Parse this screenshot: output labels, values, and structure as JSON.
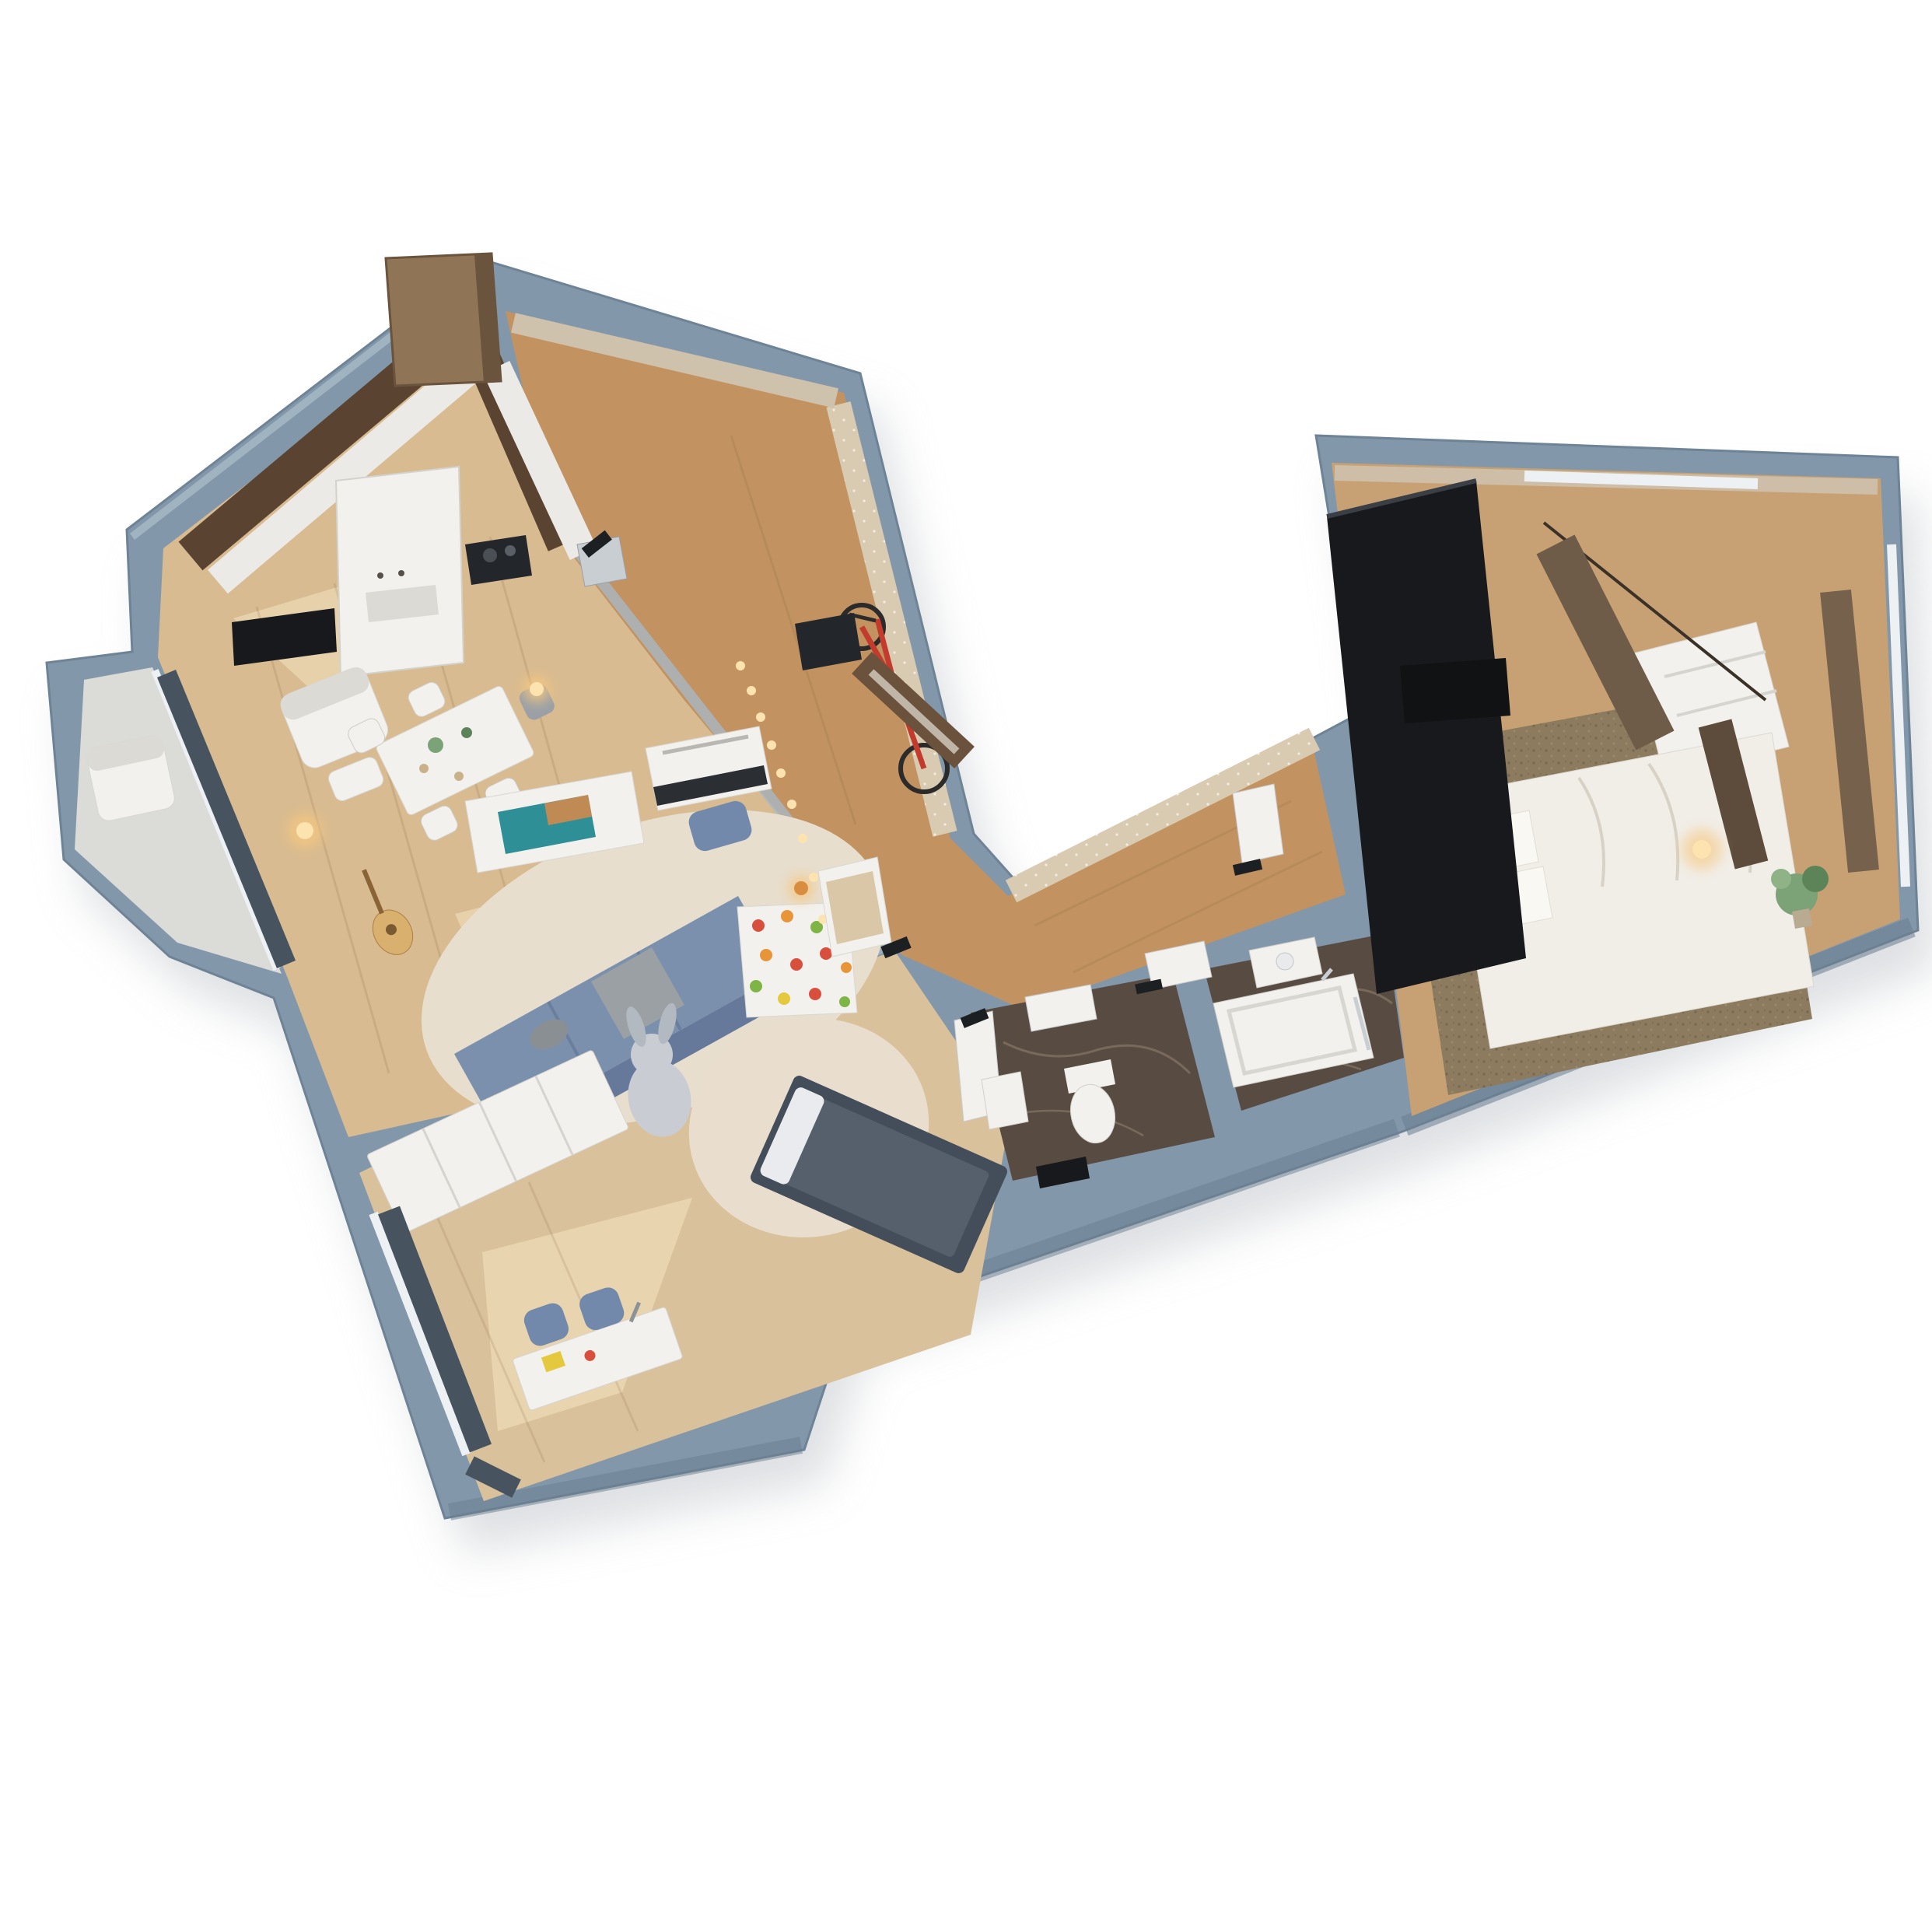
{
  "meta": {
    "title": "3D isometric apartment floor plan render",
    "view": "top-down axonometric cutaway, rotated",
    "background": "#ffffff"
  },
  "palette": {
    "bg": "#ffffff",
    "shadow": "#c3c8cd",
    "wall": "#8297a9",
    "wallDark": "#697e90",
    "wallLight": "#a7bac8",
    "wallFace": "#e8e6e1",
    "woodMain": "#d8bb91",
    "woodSun": "#f4e3c0",
    "woodHall": "#c29361",
    "woodKids": "#d9c19b",
    "woodBedroom": "#c7a173",
    "balconyFloor": "#dbdbd8",
    "marble": "#584c42",
    "marbleVein": "#8d7d6c",
    "rugCream": "#e7decd",
    "rugKids": "#e9dece",
    "rugBedroom": "#8d7b5f",
    "sofaBlue": "#7b90ad",
    "sofaBlueDark": "#66799a",
    "stoolBlue": "#7289ab",
    "kidsBed": "#434e5a",
    "kidsBedTop": "#55606c",
    "curtainSlate": "#47535f",
    "curtainBrown": "#6e5b48",
    "curtainBrownDark": "#5d4c3c",
    "furnWhite": "#f2f1ed",
    "furnWhiteShade": "#dcdad4",
    "tallWardrobeBrown": "#8f7456",
    "closetBrown": "#6b523c",
    "mirror": "#cfc8ba",
    "backsplash": "#5a4431",
    "counterWhite": "#eceae6",
    "applianceDark": "#23262a",
    "black": "#17191c",
    "bedWhite": "#f1eee8",
    "pillowWhite": "#faf8f3",
    "wallpaperTan": "#d9cbb1",
    "wallpaperTan2": "#cfc2ad",
    "glass": "#edf1f4",
    "glowAmber": "#f6c77e",
    "glowCore": "#fce3b0",
    "bikeRed": "#c23b2c",
    "tireDark": "#2b2b2b",
    "plantGreen": "#7ca277",
    "plantGreenDark": "#5d8458",
    "plushGray": "#c9cdd3",
    "plushGrayDark": "#b3b9c1",
    "tvTeal": "#2e8f96",
    "tvOrange": "#d98a4a",
    "holdRed": "#d94f3d",
    "holdOrange": "#e8953a",
    "holdGreen": "#7fb544",
    "holdYellow": "#e4c93e",
    "chrome": "#c9ced2",
    "woodSeam": "#7a5634",
    "cushionTan": "#d9c7a8"
  },
  "rooms": [
    {
      "name": "kitchen-dining",
      "features": [
        "white cabinets",
        "dark backsplash",
        "tall fridge column",
        "cooktop",
        "sink",
        "dining table",
        "four chairs",
        "white armchair",
        "wall tv",
        "tall brown wardrobe"
      ]
    },
    {
      "name": "living-room",
      "features": [
        "long blue sofa",
        "cream rug",
        "white media console with tv",
        "upright piano",
        "blue stool",
        "guitar",
        "floor lamp",
        "pendant lamp",
        "climbing wall with holds",
        "string lights"
      ]
    },
    {
      "name": "balcony",
      "features": [
        "white armchair",
        "gray tile floor",
        "chamfered parapet"
      ]
    },
    {
      "name": "hallway",
      "features": [
        "red bicycle",
        "doormat",
        "bench with cushion",
        "brown closet with mirror",
        "wood corridor",
        "dotted tan wallpaper"
      ]
    },
    {
      "name": "kids-room",
      "features": [
        "white wardrobe",
        "plush bunny",
        "round beige rug",
        "dark blue bed",
        "desk with two chairs",
        "slate curtains"
      ]
    },
    {
      "name": "wc",
      "features": [
        "toilet",
        "small sink",
        "dark marble floor",
        "white door",
        "black mat"
      ]
    },
    {
      "name": "bathroom",
      "features": [
        "bathtub",
        "sink counter",
        "dark marble floor",
        "white door",
        "chrome fittings"
      ]
    },
    {
      "name": "bedroom",
      "features": [
        "double bed with white duvet",
        "mottled brown rug",
        "black wardrobe",
        "brown curtains",
        "corner vanity",
        "plant",
        "glowing bedside lamp",
        "dark wall niche"
      ]
    }
  ]
}
